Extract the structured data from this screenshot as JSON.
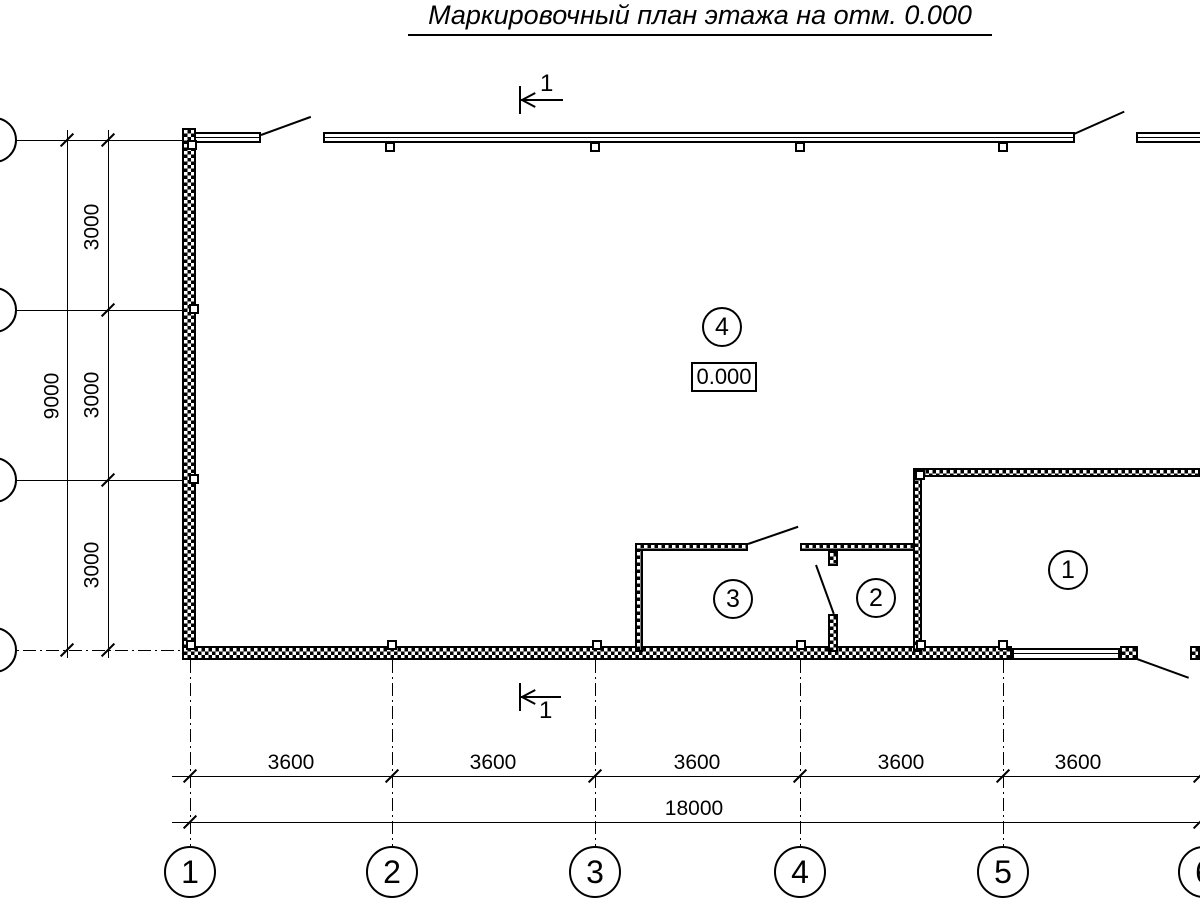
{
  "title": {
    "text": "Маркировочный план этажа на отм. 0.000"
  },
  "section_mark": {
    "top_label": "1",
    "bottom_label": "1"
  },
  "rooms": {
    "room1": {
      "number": "1"
    },
    "room2": {
      "number": "2"
    },
    "room3": {
      "number": "3"
    },
    "room4": {
      "number": "4"
    },
    "elevation": "0.000"
  },
  "axes": {
    "bottom_labels": [
      "1",
      "2",
      "3",
      "4",
      "5",
      "6"
    ]
  },
  "dimensions": {
    "bays_horizontal": [
      "3600",
      "3600",
      "3600",
      "3600",
      "3600"
    ],
    "total_horizontal": "18000",
    "bays_vertical": [
      "3000",
      "3000",
      "3000"
    ],
    "total_vertical": "9000"
  },
  "colors": {
    "line": "#000000",
    "background": "#ffffff"
  }
}
